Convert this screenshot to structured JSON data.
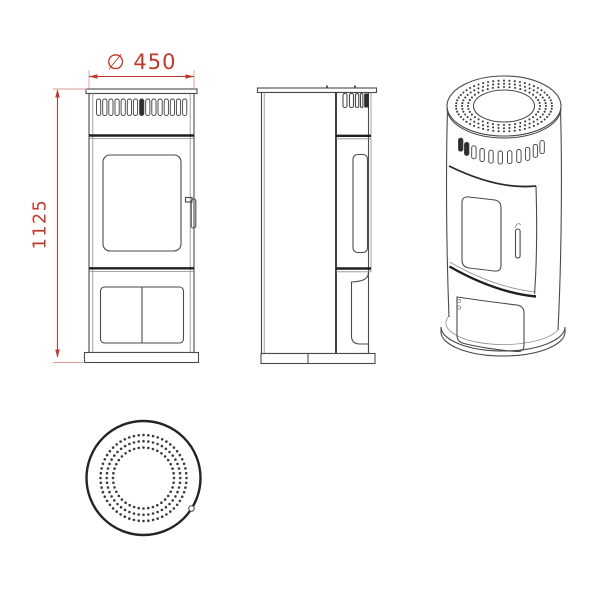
{
  "background": "#ffffff",
  "colors": {
    "line": "#4a4a4a",
    "line_heavy": "#1f1f1f",
    "dimension_red": "#c0392b"
  },
  "dimensions": {
    "diameter_label": "∅ 450",
    "height_label": "1125"
  }
}
